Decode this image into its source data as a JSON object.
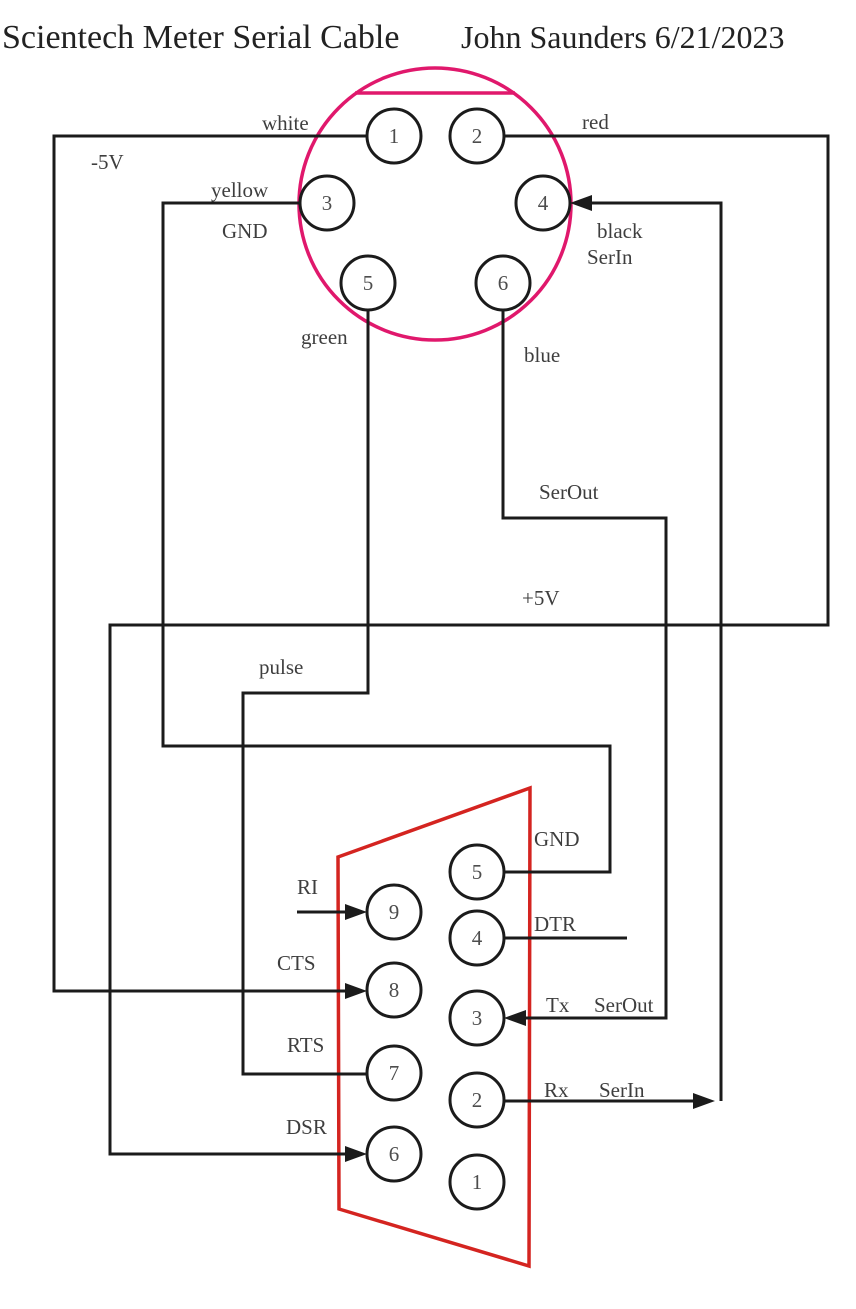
{
  "title": {
    "product": "Scientech Meter Serial Cable",
    "author_date": "John Saunders 6/21/2023"
  },
  "colors": {
    "din_outline": "#e0186c",
    "db9_outline": "#d42420",
    "wire": "#1b1b1b",
    "label_text": "#3e3e3e"
  },
  "din_connector": {
    "type": "6-pin DIN",
    "pin_numbers": [
      "1",
      "2",
      "3",
      "4",
      "5",
      "6"
    ]
  },
  "db9_connector": {
    "type": "DB9",
    "pin_numbers": [
      "9",
      "8",
      "7",
      "6",
      "5",
      "4",
      "3",
      "2",
      "1"
    ]
  },
  "labels": {
    "white": "white",
    "red": "red",
    "minus_5v": "-5V",
    "yellow": "yellow",
    "gnd_din": "GND",
    "black": "black",
    "serin_din": "SerIn",
    "green": "green",
    "blue": "blue",
    "serout_mid": "SerOut",
    "plus_5v": "+5V",
    "pulse": "pulse",
    "gnd_db9": "GND",
    "ri": "RI",
    "dtr": "DTR",
    "cts": "CTS",
    "tx": "Tx",
    "serout_db9": "SerOut",
    "rts": "RTS",
    "rx": "Rx",
    "serin_db9": "SerIn",
    "dsr": "DSR"
  },
  "connections": [
    {
      "wire": "white",
      "din_pin": "1",
      "signal": "-5V",
      "db9_pin": "8",
      "db9_signal": "CTS"
    },
    {
      "wire": "red",
      "din_pin": "2",
      "signal": "+5V",
      "db9_pin": "6",
      "db9_signal": "DSR"
    },
    {
      "wire": "yellow",
      "din_pin": "3",
      "signal": "GND",
      "db9_pin": "5",
      "db9_signal": "GND"
    },
    {
      "wire": "black",
      "din_pin": "4",
      "signal": "SerIn",
      "db9_pin": "2",
      "db9_signal": "Rx"
    },
    {
      "wire": "green",
      "din_pin": "5",
      "signal": "pulse",
      "db9_pin": "7",
      "db9_signal": "RTS"
    },
    {
      "wire": "blue",
      "din_pin": "6",
      "signal": "SerOut",
      "db9_pin": "3",
      "db9_signal": "Tx"
    }
  ]
}
